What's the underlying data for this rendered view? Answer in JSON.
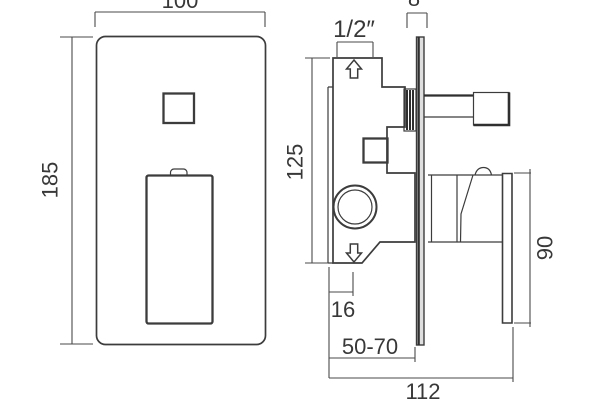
{
  "drawing": {
    "background_color": "#ffffff",
    "line_color": "#3c3c3c",
    "text_color": "#383838",
    "wall_plate_fill_color": "#dedede",
    "front_view": {
      "plate_width": "100",
      "plate_height": "185"
    },
    "side_view": {
      "inlet_size": "1/2″",
      "plate_thickness": "8",
      "body_height": "125",
      "body_offset": "16",
      "recess_depth": "50-70",
      "overall_depth": "112",
      "handle_height": "90"
    }
  }
}
